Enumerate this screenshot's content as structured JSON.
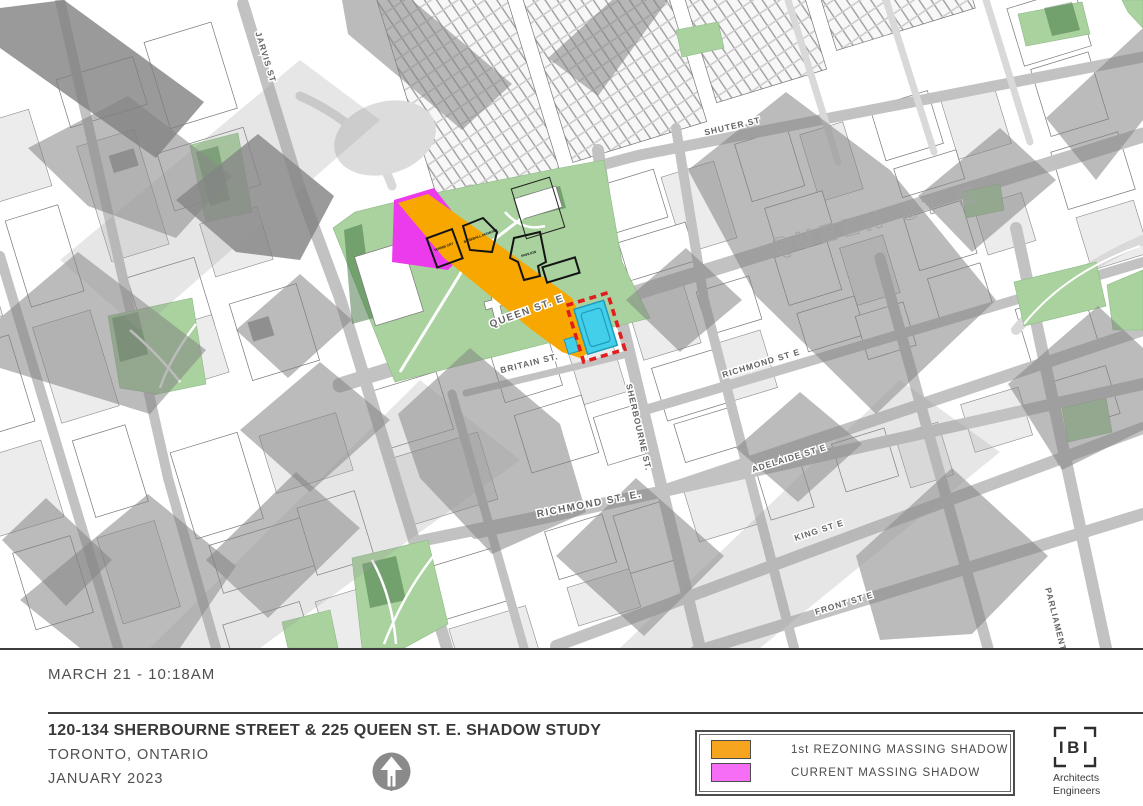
{
  "timestamp_label": "MARCH 21 - 10:18AM",
  "title_block": {
    "title": "120-134 SHERBOURNE STREET & 225 QUEEN ST. E. SHADOW STUDY",
    "location": "TORONTO, ONTARIO",
    "date": "JANUARY 2023"
  },
  "legend": {
    "items": [
      {
        "label": "1st REZONING MASSING SHADOW",
        "color": "#F6A51F"
      },
      {
        "label": "CURRENT MASSING SHADOW",
        "color": "#F56EF5"
      }
    ]
  },
  "logo": {
    "text": "IBI",
    "line1": "Architects",
    "line2": "Engineers"
  },
  "map": {
    "colors": {
      "rezoning_shadow": "#F8A700",
      "current_shadow": "#EC3BEC",
      "site_fill": "#43CFE9",
      "site_detail": "#1E9CBE",
      "site_outline": "#E11D1D",
      "park": "#A9D29E",
      "park_shade": "#679966"
    },
    "street_labels": [
      {
        "text": "JARVIS ST",
        "x": 263,
        "y": 58,
        "r": 73,
        "cls": "st sm"
      },
      {
        "text": "SHUTER ST",
        "x": 733,
        "y": 129,
        "r": -13,
        "cls": "st sm"
      },
      {
        "text": "QUEEN ST. E",
        "x": 528,
        "y": 314,
        "r": -20,
        "cls": "st"
      },
      {
        "text": "QUEEN ST E",
        "x": 878,
        "y": 228,
        "r": -15,
        "cls": "st outline"
      },
      {
        "text": "BRITAIN ST.",
        "x": 530,
        "y": 366,
        "r": -14,
        "cls": "st sm"
      },
      {
        "text": "SHERBOURNE ST.",
        "x": 636,
        "y": 428,
        "r": 77,
        "cls": "st sm"
      },
      {
        "text": "RICHMOND ST E",
        "x": 762,
        "y": 366,
        "r": -17,
        "cls": "st sm"
      },
      {
        "text": "RICHMOND ST. E.",
        "x": 590,
        "y": 507,
        "r": -11,
        "cls": "st"
      },
      {
        "text": "ADELAIDE ST E",
        "x": 790,
        "y": 461,
        "r": -17,
        "cls": "st sm"
      },
      {
        "text": "KING ST E",
        "x": 820,
        "y": 533,
        "r": -18,
        "cls": "st sm"
      },
      {
        "text": "FRONT ST E",
        "x": 845,
        "y": 606,
        "r": -17,
        "cls": "st sm"
      },
      {
        "text": "PARLIAMENT ST",
        "x": 1055,
        "y": 628,
        "r": 76,
        "cls": "st sm"
      }
    ],
    "park_labels": [
      {
        "text": "TENNIS CRT",
        "x": 444,
        "y": 248,
        "r": -20,
        "cls": "tiny"
      },
      {
        "text": "BASEBALL DIAMOND",
        "x": 481,
        "y": 237,
        "r": -20,
        "cls": "tiny"
      },
      {
        "text": "PAVILION",
        "x": 529,
        "y": 255,
        "r": -17,
        "cls": "tiny"
      }
    ]
  }
}
